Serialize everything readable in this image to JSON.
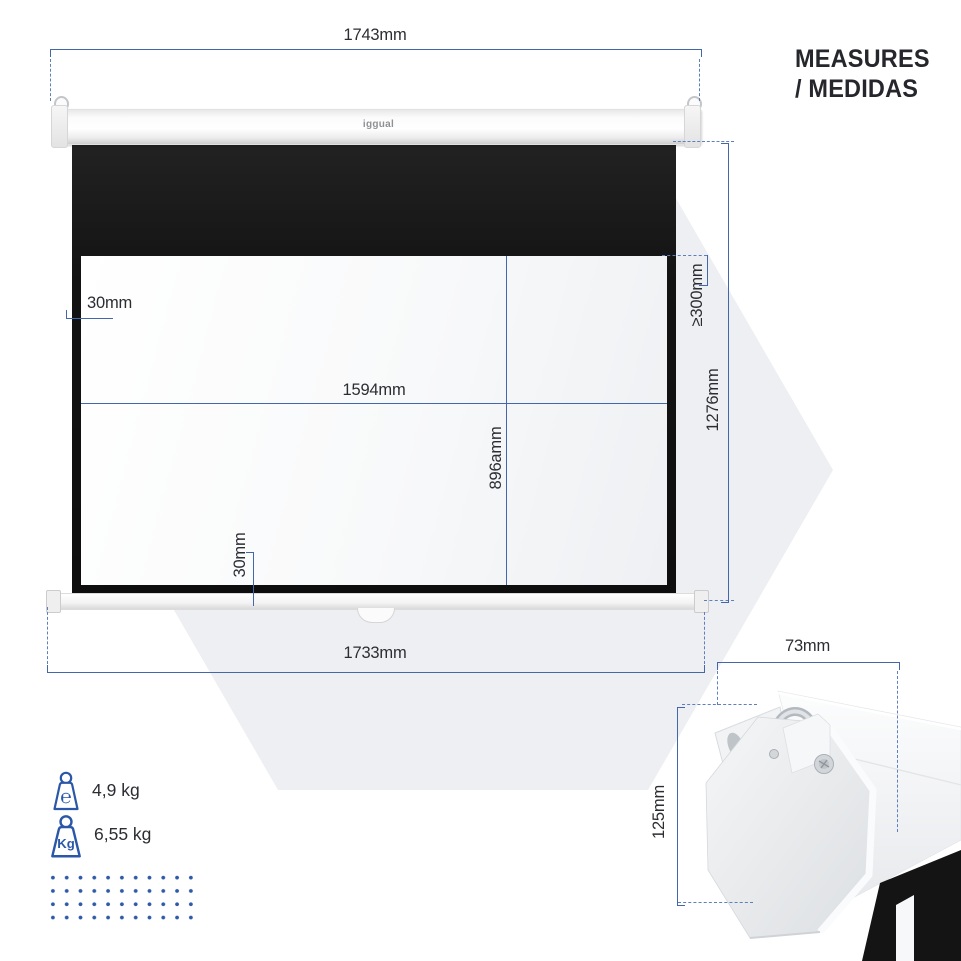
{
  "title": {
    "line1": "MEASURES",
    "line2": "/ MEDIDAS"
  },
  "brand_logo": "iggual",
  "dimensions": {
    "housing_width": "1743mm",
    "screen_width": "1733mm",
    "total_height": "1276mm",
    "top_black_drop": "≥300mm",
    "viewing_width": "1594mm",
    "viewing_height": "896amm",
    "left_border": "30mm",
    "bottom_border": "30mm",
    "bracket_depth": "73mm",
    "bracket_height": "125mm"
  },
  "weights": {
    "net": {
      "icon_text": "℮",
      "label": "4,9 kg"
    },
    "gross": {
      "icon_text": "Kg",
      "label": "6,55 kg"
    }
  },
  "colors": {
    "dimension_blue": "#4467ab",
    "accent_blue": "#2b57a8",
    "text_dark": "#2c2d32",
    "fabric_black": "#141414",
    "hexagon_gray": "#edeff2"
  }
}
